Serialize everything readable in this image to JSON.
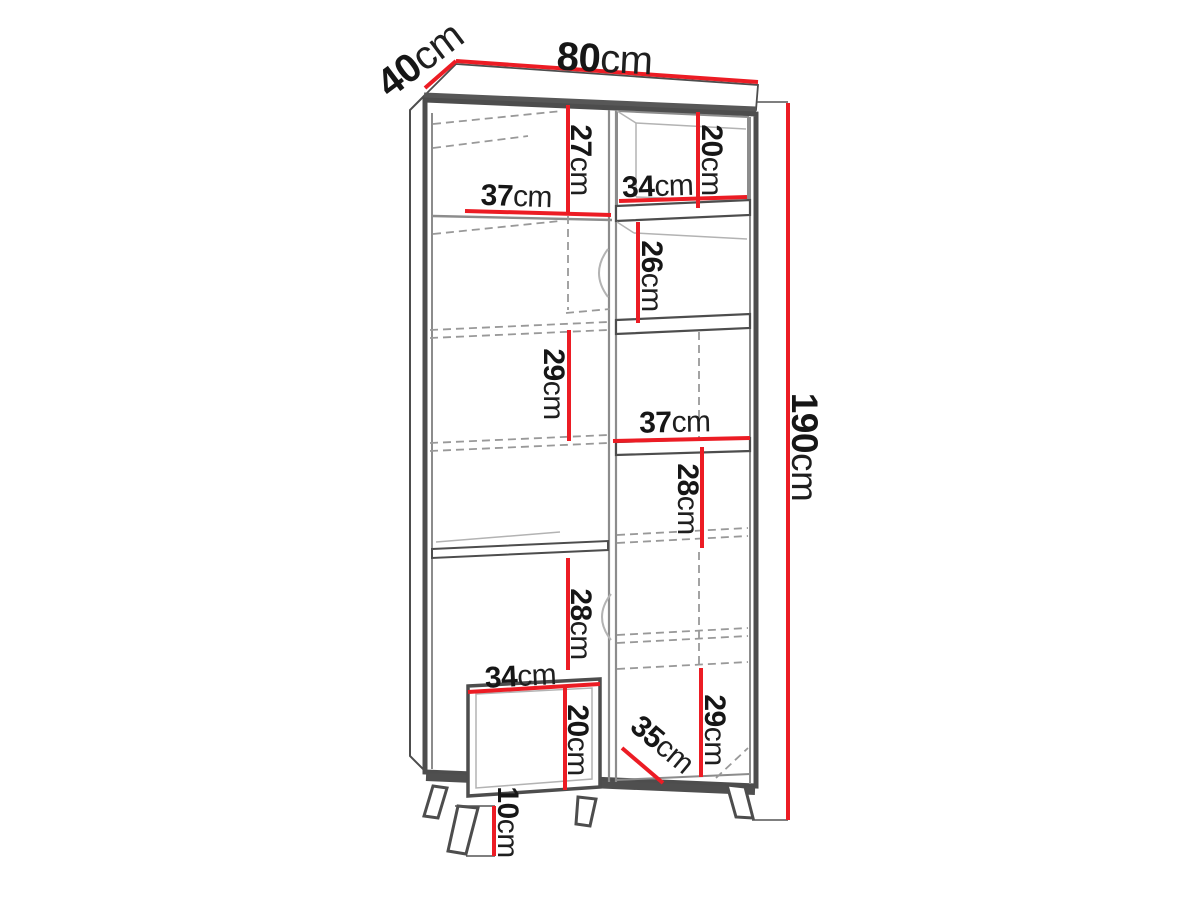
{
  "figure": {
    "kind": "furniture-dimension-diagram",
    "subject": "tall two-column bookcase cabinet with legs"
  },
  "colors": {
    "dimension_line": "#ec1c24",
    "outline": "#4d4d4d",
    "interior_line": "#8c8c8c",
    "background": "#ffffff",
    "text": "#161616"
  },
  "dims": {
    "width": {
      "value": "80",
      "unit": "cm"
    },
    "depth": {
      "value": "40",
      "unit": "cm"
    },
    "height": {
      "value": "190",
      "unit": "cm"
    },
    "top_left_niche_width": {
      "value": "37",
      "unit": "cm"
    },
    "top_left_niche_height": {
      "value": "27",
      "unit": "cm"
    },
    "top_right_niche_width": {
      "value": "34",
      "unit": "cm"
    },
    "top_right_niche_height": {
      "value": "20",
      "unit": "cm"
    },
    "right_upper_niche_height": {
      "value": "26",
      "unit": "cm"
    },
    "left_middle_niche_height": {
      "value": "29",
      "unit": "cm"
    },
    "right_middle_niche_width": {
      "value": "37",
      "unit": "cm"
    },
    "right_middle_niche_height": {
      "value": "28",
      "unit": "cm"
    },
    "left_lower_niche_height": {
      "value": "28",
      "unit": "cm"
    },
    "bottom_left_niche_width": {
      "value": "34",
      "unit": "cm"
    },
    "bottom_left_niche_height": {
      "value": "20",
      "unit": "cm"
    },
    "bottom_right_niche_width": {
      "value": "35",
      "unit": "cm"
    },
    "bottom_right_niche_height": {
      "value": "29",
      "unit": "cm"
    },
    "legs_height": {
      "value": "10",
      "unit": "cm"
    }
  }
}
